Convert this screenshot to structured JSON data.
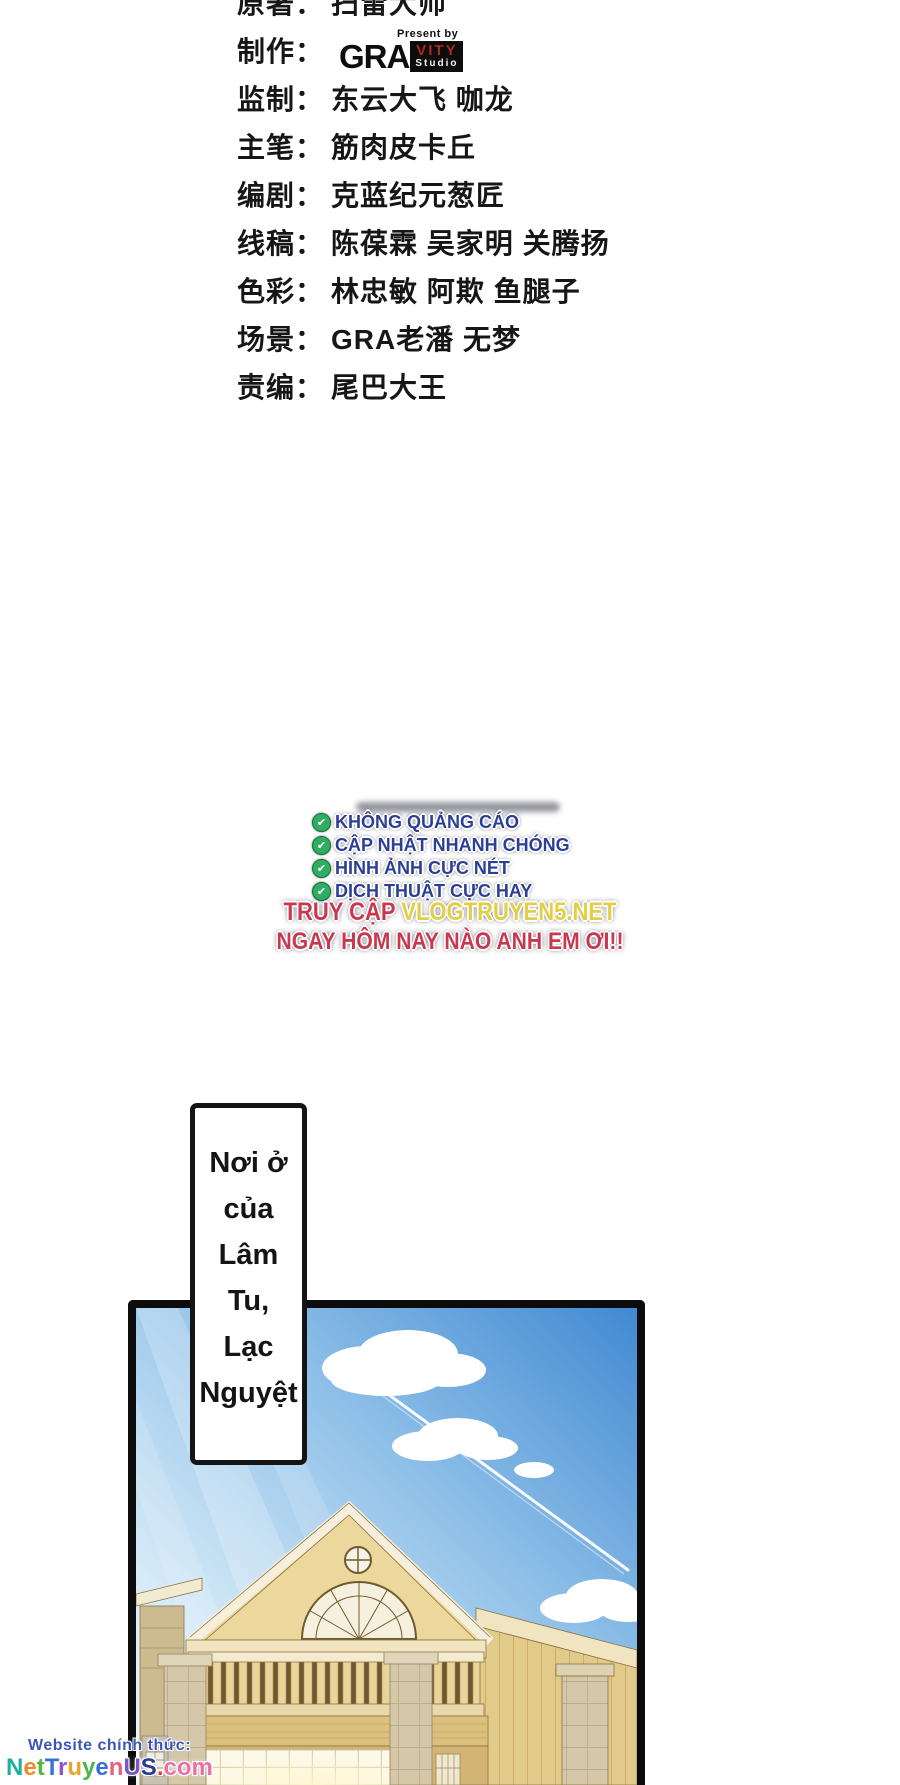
{
  "credits": {
    "rows": [
      {
        "label": "原著：",
        "value": "扫雷大师"
      },
      {
        "label": "制作：",
        "value": ""
      },
      {
        "label": "监制：",
        "value": "东云大飞 咖龙"
      },
      {
        "label": "主笔：",
        "value": "筋肉皮卡丘"
      },
      {
        "label": "编剧：",
        "value": "克蓝纪元葱匠"
      },
      {
        "label": "线稿：",
        "value": "陈葆霖 吴家明 关腾扬"
      },
      {
        "label": "色彩：",
        "value": "林忠敏 阿欺 鱼腿子"
      },
      {
        "label": "场景：",
        "value": "GRA老潘 无梦"
      },
      {
        "label": "责编：",
        "value": "尾巴大王"
      }
    ],
    "logo": {
      "present_by": "Present by",
      "gra": "GRA",
      "vity": "VITY",
      "studio": "Studio",
      "box_color": "#0d0d0d",
      "vity_color": "#a82a18"
    }
  },
  "promo": {
    "features": [
      "KHÔNG QUẢNG CÁO",
      "CẬP NHẬT NHANH CHÓNG",
      "HÌNH ẢNH CỰC NÉT",
      "DỊCH THUẬT CỰC HAY"
    ],
    "cta_prefix": "TRUY CẬP ",
    "cta_site": "VLOGTRUYEN5.NET",
    "cta_line2": "NGAY HÔM NAY NÀO ANH EM ƠI!!",
    "check_icon": "✔",
    "colors": {
      "feature_text": "#2c3f96",
      "cta_red": "#c9384f",
      "cta_yellow": "#e3cf45",
      "check_green": "#2fae62"
    }
  },
  "speech_bubble": {
    "lines": [
      "Nơi ở",
      "của",
      "Lâm",
      "Tu,",
      "Lạc",
      "Nguyệt"
    ]
  },
  "panel": {
    "scene": "house-under-blue-sky",
    "colors": {
      "sky_deep": "#4289d2",
      "sky_pale": "#eef7fc",
      "wood_light": "#ecd79c",
      "wood_mid": "#e2ca8b",
      "trim": "#f6efdb",
      "stone": "#d4c8a9"
    }
  },
  "watermark": {
    "line1": "Website chính thức:",
    "line1_color": "#3d55b8",
    "letters": [
      {
        "ch": "N",
        "color": "#1fae9e"
      },
      {
        "ch": "e",
        "color": "#f08a28"
      },
      {
        "ch": "t",
        "color": "#56b53c"
      },
      {
        "ch": "T",
        "color": "#3a6fd8"
      },
      {
        "ch": "r",
        "color": "#9050d0"
      },
      {
        "ch": "u",
        "color": "#f0a028"
      },
      {
        "ch": "y",
        "color": "#4ab548"
      },
      {
        "ch": "e",
        "color": "#3a6fd8"
      },
      {
        "ch": "n",
        "color": "#e86080"
      },
      {
        "ch": "U",
        "color": "#7a55cc"
      },
      {
        "ch": "S",
        "color": "#2a3a90"
      },
      {
        "ch": ".",
        "color": "#e04040"
      },
      {
        "ch": "c",
        "color": "#ea6fa8"
      },
      {
        "ch": "o",
        "color": "#ea6fa8"
      },
      {
        "ch": "m",
        "color": "#ea6fa8"
      }
    ]
  }
}
